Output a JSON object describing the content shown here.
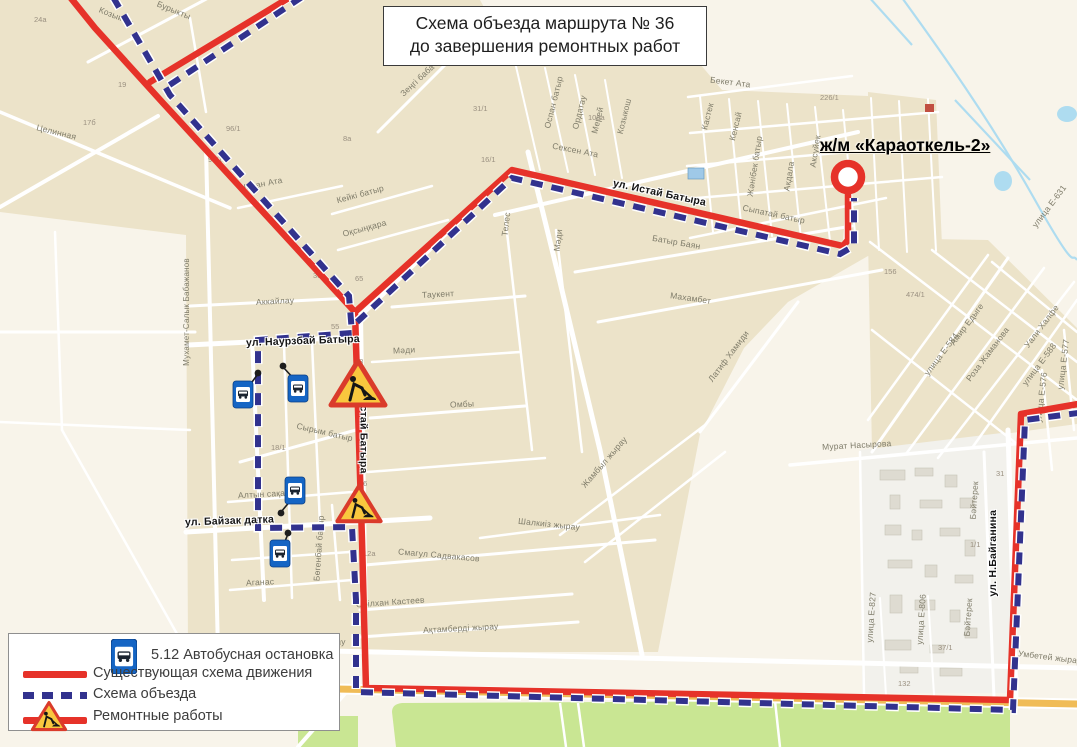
{
  "title": {
    "line1": "Схема объезда маршрута № 36",
    "line2": "до завершения ремонтных работ"
  },
  "destination": {
    "label": "ж/м «Караоткель-2»"
  },
  "legend": {
    "items": [
      {
        "icon": "bus-stop-sign-icon",
        "label": "5.12 Автобусная остановка"
      },
      {
        "icon": "solid-line-swatch",
        "label": "Существующая схема движения"
      },
      {
        "icon": "dashed-line-swatch",
        "label": "Схема объезда"
      },
      {
        "icon": "roadworks-sign-icon",
        "label": "Ремонтные работы"
      }
    ]
  },
  "colors": {
    "existing_route": "#e63229",
    "detour_route": "#32328e",
    "roadworks_sign_fill": "#f9c73e",
    "roadworks_sign_border": "#da3b2b",
    "bus_sign_blue": "#1565c4",
    "park_green": "#c9e693",
    "water_blue": "#aedcf0",
    "orange_road": "#f0bc57",
    "block_beige": "#ece3c9",
    "background_cream": "#f8f4ea"
  },
  "map": {
    "streets": [
      {
        "text": "Целинная"
      },
      {
        "text": "Козыкош"
      },
      {
        "text": "Бурыкты"
      },
      {
        "text": "Шопан Ата"
      },
      {
        "text": "Мухамет-Салык Бабажанов"
      },
      {
        "text": "Аккайлау"
      },
      {
        "text": "Кейкі батыр"
      },
      {
        "text": "Оқсыңқара"
      },
      {
        "text": "Зеңгі баба"
      },
      {
        "text": "Оспан батыр"
      },
      {
        "text": "Ордатау"
      },
      {
        "text": "Мерей"
      },
      {
        "text": "Козыкош"
      },
      {
        "text": "Сексен Ата"
      },
      {
        "text": "Бекет Ата"
      },
      {
        "text": "Кастек"
      },
      {
        "text": "Кенсай"
      },
      {
        "text": "Жәнібек батыр"
      },
      {
        "text": "Акдала"
      },
      {
        "text": "Аксуйек"
      },
      {
        "text": "Сыпатай батыр"
      },
      {
        "text": "Батыр Баян"
      },
      {
        "text": "Махамбет"
      },
      {
        "text": "Телес"
      },
      {
        "text": "Мәди"
      },
      {
        "text": "Таукент"
      },
      {
        "text": "Мәди"
      },
      {
        "text": "Сырым батыр"
      },
      {
        "text": "Омбы"
      },
      {
        "text": "Латиф Хамиди"
      },
      {
        "text": "Жамбыл жырау"
      },
      {
        "text": "Смагул Садвакасов"
      },
      {
        "text": "Шалкиіз жырау"
      },
      {
        "text": "Алтын сақа"
      },
      {
        "text": "Аганас"
      },
      {
        "text": "Бөгенбай батыр"
      },
      {
        "text": "Әбілхан Кастеев"
      },
      {
        "text": "Ақтамберді жырау"
      },
      {
        "text": "Умбетей жырау"
      },
      {
        "text": "Умбетей жырау"
      },
      {
        "text": "Мурат Насырова"
      },
      {
        "text": "улица Е-584"
      },
      {
        "text": "Амир Едыге"
      },
      {
        "text": "Роза Жаманова"
      },
      {
        "text": "Уали Халфе"
      },
      {
        "text": "улица Е-588"
      },
      {
        "text": "улица Е-631"
      },
      {
        "text": "улица Е-576"
      },
      {
        "text": "улица Е-577"
      },
      {
        "text": "Бәйтерек"
      },
      {
        "text": "Бәйтерек"
      },
      {
        "text": "улица Е-827"
      },
      {
        "text": "улица Е-806"
      },
      {
        "text": "ул. Истай Батыра"
      },
      {
        "text": "ул. Истай Батыра"
      },
      {
        "text": "ул. Наурзбай Батыра"
      },
      {
        "text": "ул. Байзак датка"
      },
      {
        "text": "ул. Н.Байганина"
      }
    ],
    "numbers": [
      {
        "text": "24а"
      },
      {
        "text": "19"
      },
      {
        "text": "17б"
      },
      {
        "text": "96/1"
      },
      {
        "text": "94/1"
      },
      {
        "text": "8а"
      },
      {
        "text": "31/1"
      },
      {
        "text": "16/1"
      },
      {
        "text": "100а"
      },
      {
        "text": "226/1"
      },
      {
        "text": "156"
      },
      {
        "text": "474/1"
      },
      {
        "text": "30а"
      },
      {
        "text": "65"
      },
      {
        "text": "55"
      },
      {
        "text": "48"
      },
      {
        "text": "18/1"
      },
      {
        "text": "26"
      },
      {
        "text": "12а"
      },
      {
        "text": "31"
      },
      {
        "text": "1/1"
      },
      {
        "text": "37/1"
      },
      {
        "text": "132"
      }
    ]
  }
}
